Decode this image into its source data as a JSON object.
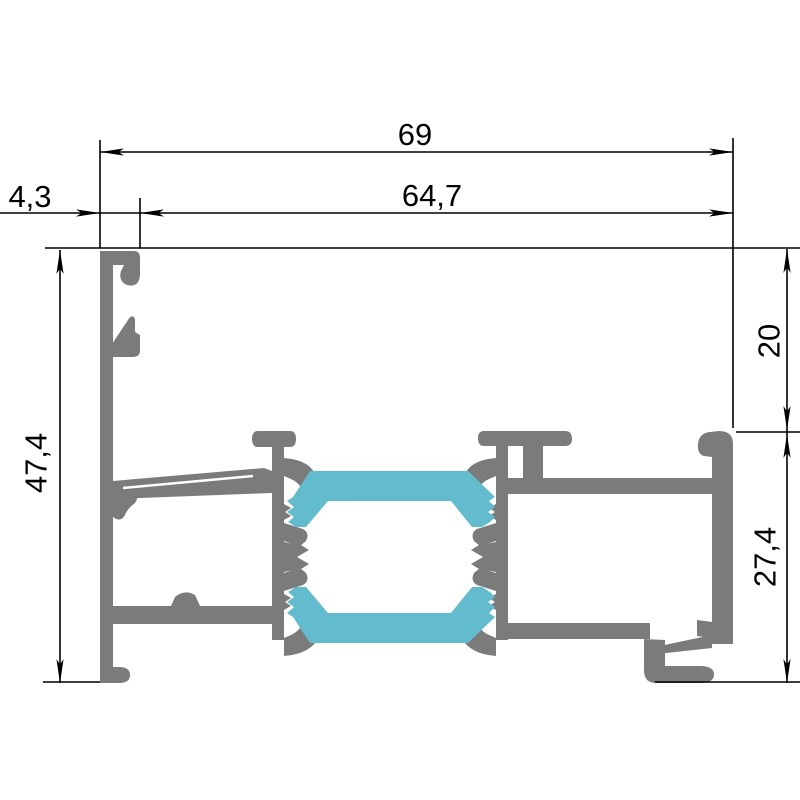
{
  "drawing": {
    "type": "aluminium-window-profile-cross-section",
    "dimensions": {
      "width_total": "69",
      "width_inner": "64,7",
      "width_wall": "4,3",
      "height_total": "47,4",
      "height_top": "20",
      "height_bottom": "27,4"
    },
    "colors": {
      "aluminum": "#7b7b7b",
      "thermal_break": "#63bccd",
      "lines": "#000000",
      "background": "#ffffff"
    }
  }
}
